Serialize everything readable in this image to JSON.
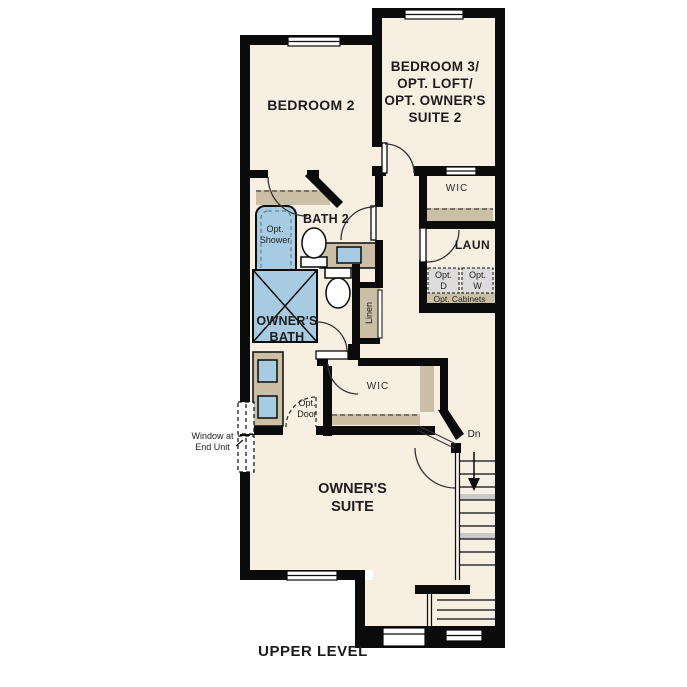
{
  "title": "UPPER LEVEL",
  "colors": {
    "floor": "#f6efe2",
    "wall": "#0b0b0b",
    "cabinet_tan": "#cbbfa5",
    "fixture_blue": "#a7cbe1",
    "appliance_gray": "#dcdcdc",
    "line": "#2a2a2a"
  },
  "rooms": {
    "bedroom2": {
      "label": "BEDROOM 2"
    },
    "bedroom3": {
      "lines": [
        "BEDROOM 3/",
        "OPT. LOFT/",
        "OPT. OWNER'S",
        "SUITE 2"
      ]
    },
    "wic_upper": {
      "label": "WIC"
    },
    "bath2": {
      "label": "BATH 2"
    },
    "laundry": {
      "label": "LAUN"
    },
    "owners_bath": {
      "lines": [
        "OWNER'S",
        "BATH"
      ]
    },
    "wic_owners": {
      "label": "WIC"
    },
    "owners_suite": {
      "lines": [
        "OWNER'S",
        "SUITE"
      ]
    }
  },
  "annotations": {
    "opt_shower": {
      "lines": [
        "Opt.",
        "Shower"
      ]
    },
    "opt_dryer": {
      "lines": [
        "Opt.",
        "D"
      ]
    },
    "opt_washer": {
      "lines": [
        "Opt.",
        "W"
      ]
    },
    "opt_cabinets": {
      "label": "Opt. Cabinets"
    },
    "linen": {
      "label": "Linen"
    },
    "opt_door": {
      "lines": [
        "Opt.",
        "Door"
      ]
    },
    "window_end_unit": {
      "lines": [
        "Window at",
        "End Unit"
      ]
    },
    "stairs_down": {
      "label": "Dn"
    }
  }
}
